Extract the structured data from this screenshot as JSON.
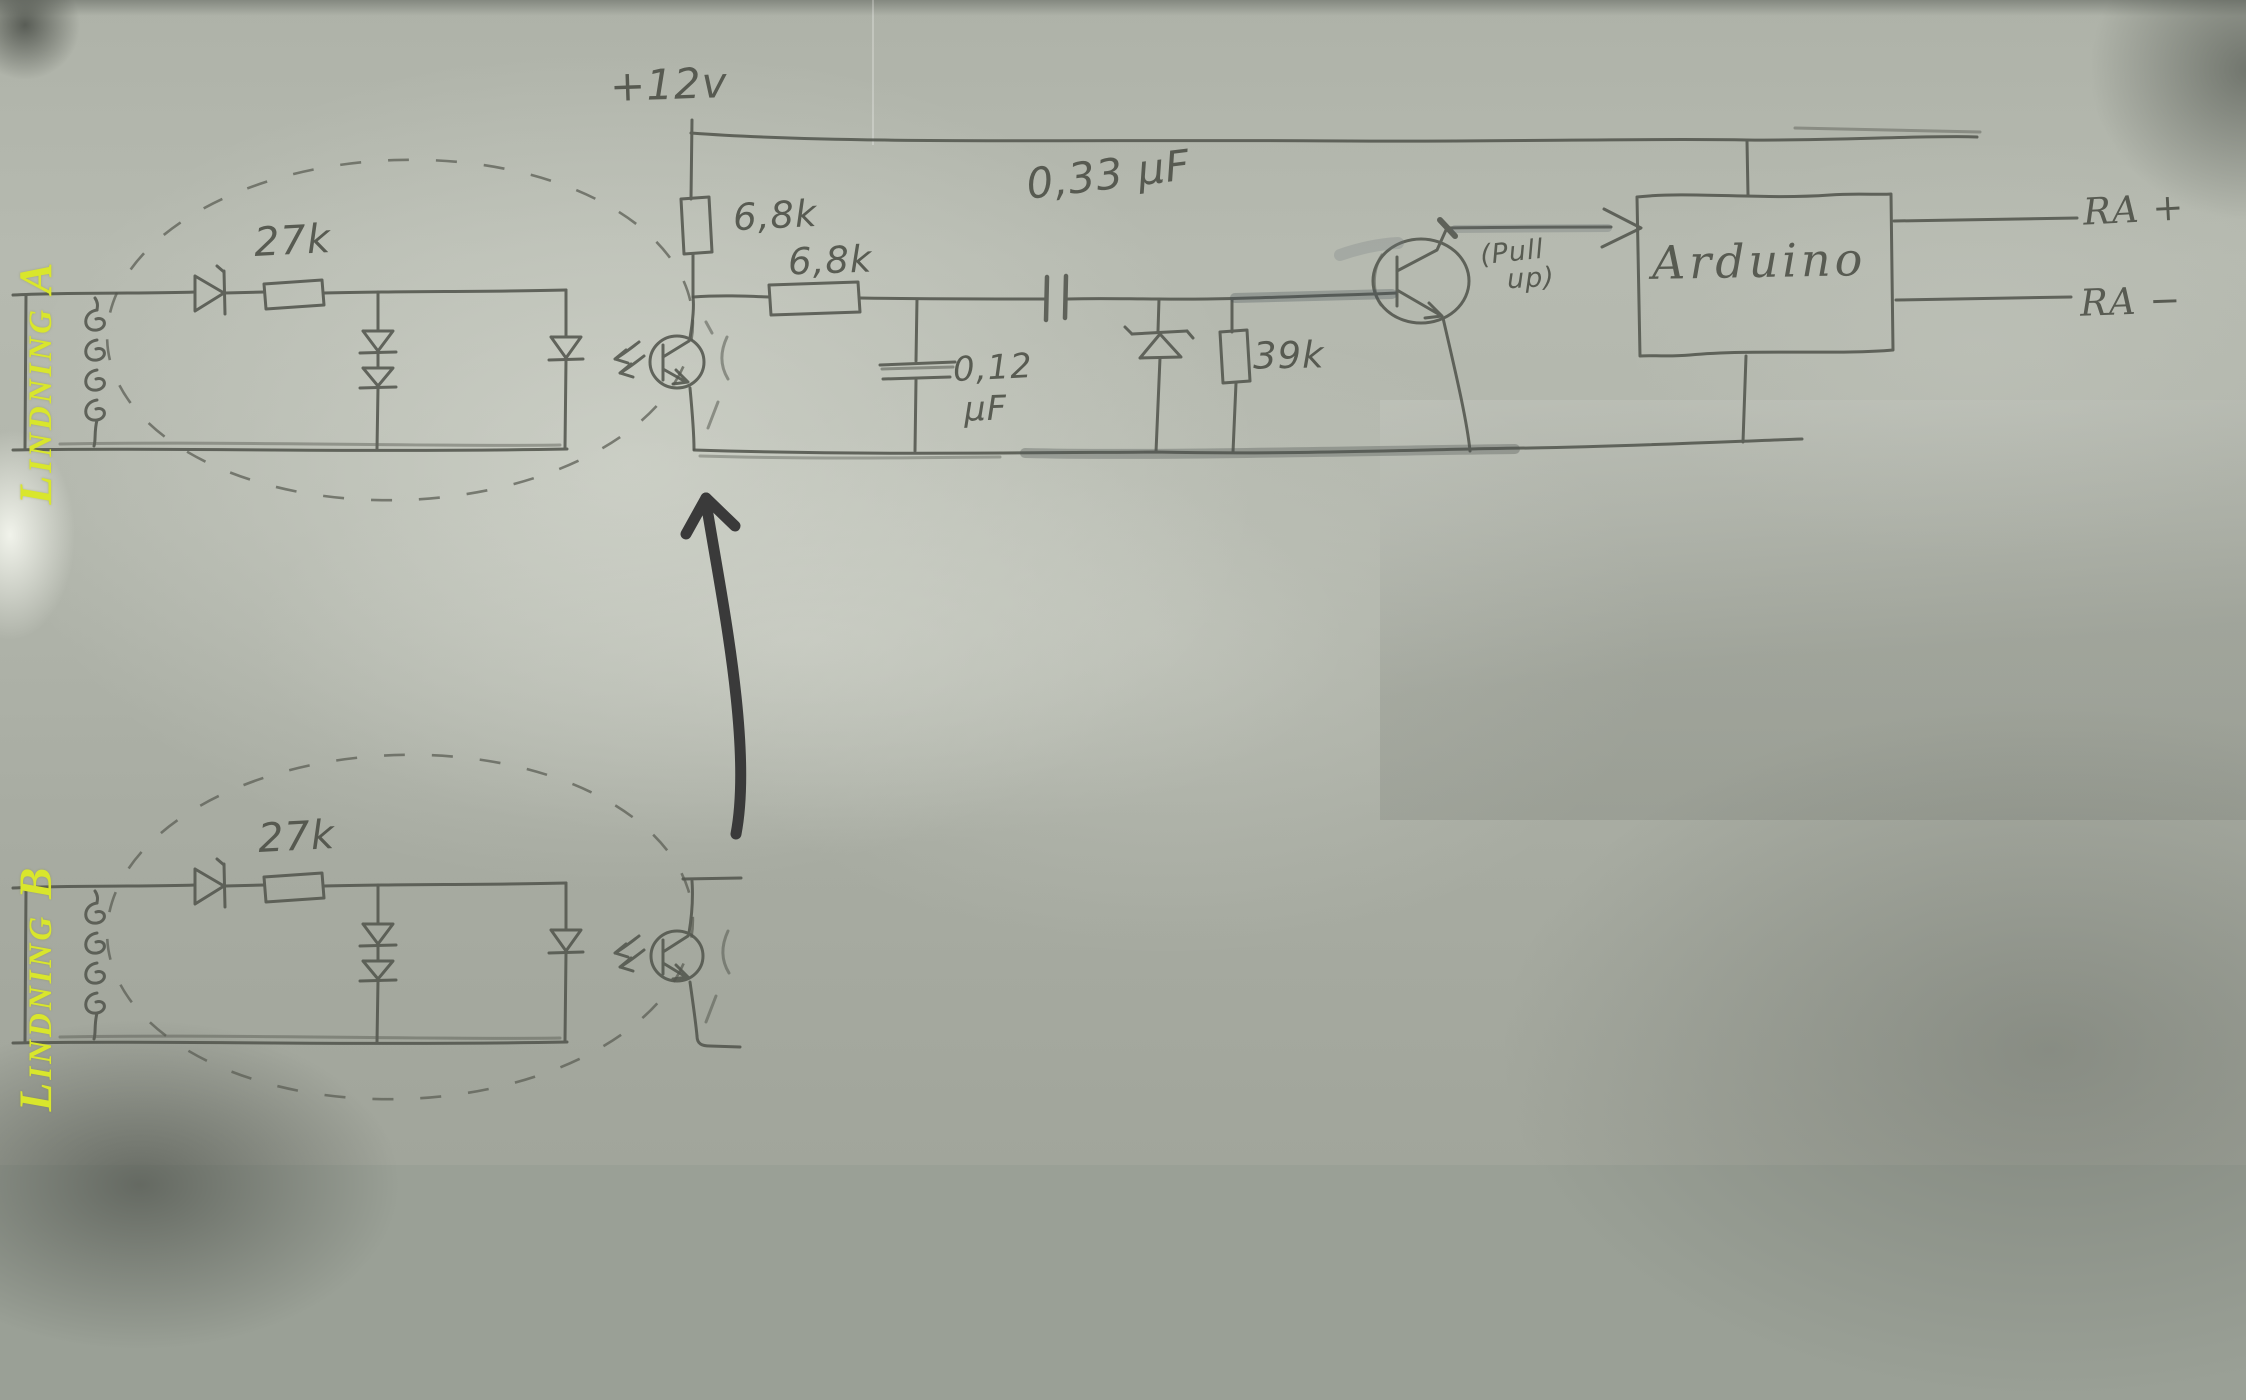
{
  "photo": {
    "description": "hand-drawn pencil schematic on gray photographed paper",
    "pencil_color": "#4b4e45",
    "paper_tint": "#b3b7ad",
    "annotation_arrow_color": "#3a3a3a"
  },
  "windings": {
    "label_color": "#d9e62c",
    "a": {
      "label": "Lindning A",
      "input_resistor": "27k"
    },
    "b": {
      "label": "Lindning B",
      "input_resistor": "27k"
    }
  },
  "main_circuit": {
    "supply": "+12v",
    "pullup_resistor": "6,8k",
    "series_resistor": "6,8k",
    "coupling_capacitor": "0,33 µF",
    "filter_capacitor_value": "0,12",
    "filter_capacitor_unit": "µF",
    "base_resistor": "39k",
    "transistor_note_line1": "(Pull",
    "transistor_note_line2": "up)",
    "controller": "Arduino",
    "output_positive": "RA +",
    "output_negative": "RA −"
  }
}
